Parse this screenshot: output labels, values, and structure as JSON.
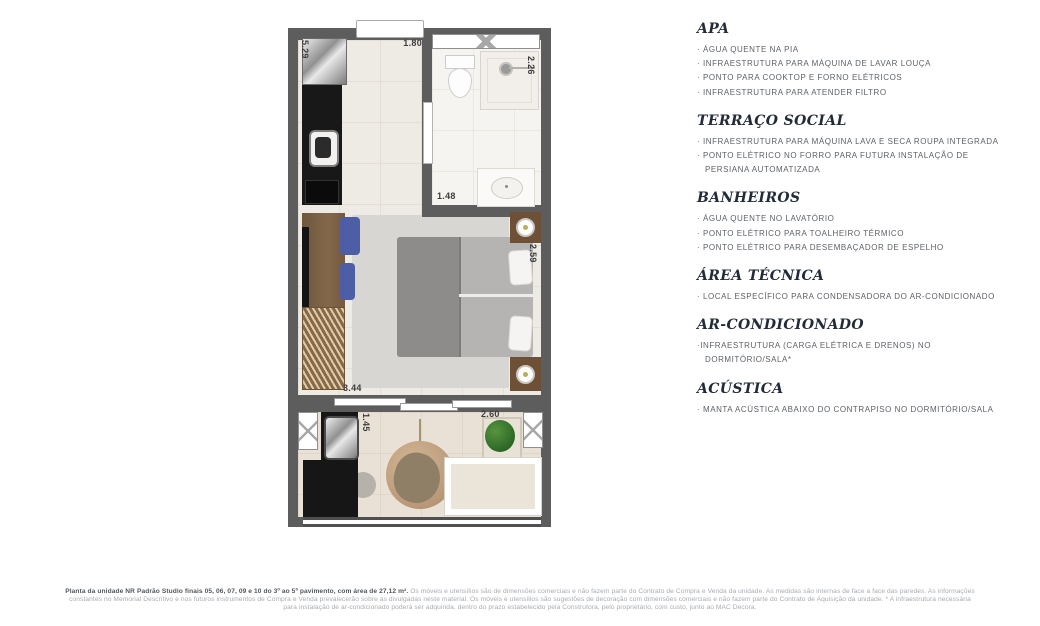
{
  "plan": {
    "dimensions": {
      "kitchen_height": "5.29",
      "kitchen_width": "1.80",
      "bathroom_depth": "2.26",
      "bathroom_width": "1.48",
      "bedroom_depth": "2.59",
      "bedroom_width": "3.44",
      "terrace_depth": "1.45",
      "terrace_width": "2.60"
    }
  },
  "specs": {
    "sections": [
      {
        "title": "APA",
        "items": [
          "· ÁGUA QUENTE NA PIA",
          "· INFRAESTRUTURA PARA MÁQUINA DE LAVAR LOUÇA",
          "· PONTO PARA COOKTOP E FORNO ELÉTRICOS",
          "· INFRAESTRUTURA PARA ATENDER FILTRO"
        ]
      },
      {
        "title": "TERRAÇO SOCIAL",
        "items": [
          "· INFRAESTRUTURA PARA MÁQUINA LAVA E SECA ROUPA INTEGRADA",
          "· PONTO ELÉTRICO NO FORRO PARA FUTURA INSTALAÇÃO DE PERSIANA AUTOMATIZADA"
        ]
      },
      {
        "title": "BANHEIROS",
        "items": [
          "· ÁGUA QUENTE NO LAVATÓRIO",
          "· PONTO ELÉTRICO PARA TOALHEIRO TÉRMICO",
          "· PONTO ELÉTRICO PARA DESEMBAÇADOR DE ESPELHO"
        ]
      },
      {
        "title": "ÁREA TÉCNICA",
        "items": [
          "· LOCAL ESPECÍFICO PARA CONDENSADORA DO AR-CONDICIONADO"
        ]
      },
      {
        "title": "AR-CONDICIONADO",
        "items": [
          "·INFRAESTRUTURA (CARGA ELÉTRICA E DRENOS) NO DORMITÓRIO/SALA*"
        ]
      },
      {
        "title": "ACÚSTICA",
        "items": [
          "· MANTA ACÚSTICA ABAIXO DO CONTRAPISO NO DORMITÓRIO/SALA"
        ]
      }
    ]
  },
  "disclaimer": {
    "lead": "Planta da unidade NR Padrão Studio finais 05, 06, 07, 09 e 10 do 3º ao 5º pavimento, com área de 27,12 m².",
    "body": " Os móveis e utensílios são de dimensões comerciais e não fazem parte do Contrato de Compra e Venda da unidade. As medidas são internas de face a face das paredes. As informações constantes no Memorial Descritivo e nos futuros instrumentos de Compra e Venda prevalecerão sobre as divulgadas neste material. Os móveis e utensílios são sugestões de decoração com dimensões comerciais e não fazem parte do Contrato de Aquisição da unidade. * A infraestrutura necessária para instalação de ar-condicionado poderá ser adquirida, dentro do prazo estabelecido pela Construtora, pelo proprietário, com custo, junto ao MAC Decora."
  },
  "colors": {
    "wall": "#5d5d5d",
    "heading": "#232a38",
    "body_text": "#5d6268",
    "accent_blue": "#4d5ea7",
    "plant_green": "#3c7a2e"
  }
}
